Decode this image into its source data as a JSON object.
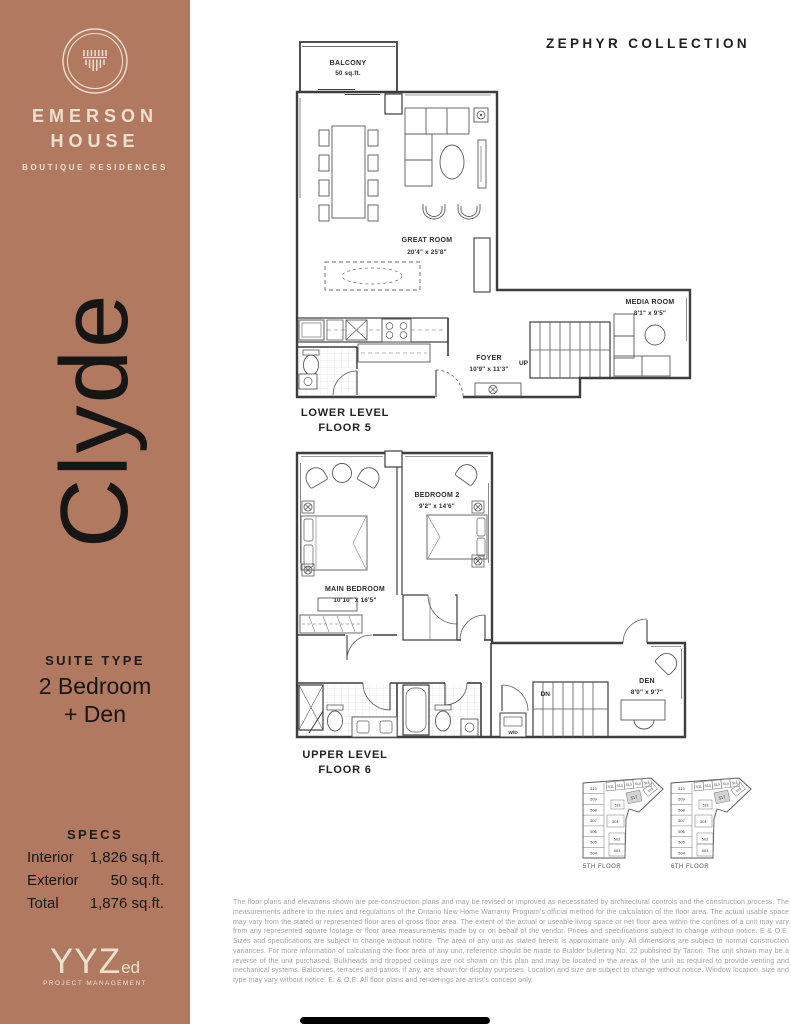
{
  "sidebar": {
    "brand_line1": "EMERSON",
    "brand_line2": "HOUSE",
    "brand_tagline": "BOUTIQUE RESIDENCES",
    "suite_name": "Clyde",
    "suite_type_heading": "SUITE TYPE",
    "suite_type_line1": "2 Bedroom",
    "suite_type_line2": "+ Den",
    "specs_heading": "SPECS",
    "specs": [
      {
        "label": "Interior",
        "value": "1,826 sq.ft."
      },
      {
        "label": "Exterior",
        "value": "50 sq.ft."
      },
      {
        "label": "Total",
        "value": "1,876 sq.ft."
      }
    ],
    "footer_brand": "YYZ",
    "footer_brand_suffix": "ed",
    "footer_brand_sub": "PROJECT MANAGEMENT",
    "accent_color": "#b1795f",
    "cream_color": "#ece0d1"
  },
  "header": {
    "collection_title": "ZEPHYR COLLECTION"
  },
  "plans": {
    "lower": {
      "caption_line1": "LOWER LEVEL",
      "caption_line2": "FLOOR 5",
      "balcony_name": "BALCONY",
      "balcony_size": "50 sq.ft.",
      "great_room_name": "GREAT ROOM",
      "great_room_size": "20'4\" x 25'8\"",
      "media_room_name": "MEDIA ROOM",
      "media_room_size": "8'1\" x 9'5\"",
      "foyer_name": "FOYER",
      "foyer_size": "10'9\" x 11'3\"",
      "stair_label": "UP"
    },
    "upper": {
      "caption_line1": "UPPER LEVEL",
      "caption_line2": "FLOOR 6",
      "bedroom2_name": "BEDROOM 2",
      "bedroom2_size": "9'2\" x 14'6\"",
      "main_bedroom_name": "MAIN BEDROOM",
      "main_bedroom_size": "10'10\" x 16'5\"",
      "den_name": "DEN",
      "den_size": "8'0\" x 9'7\"",
      "stair_label": "DN",
      "laundry_label": "W/D"
    }
  },
  "key_plans": [
    {
      "caption": "5TH FLOOR",
      "highlighted_unit": "517",
      "column_units": [
        "510",
        "509",
        "508",
        "507",
        "506",
        "505",
        "504"
      ],
      "top_units": [
        "511",
        "512",
        "513",
        "514",
        "515"
      ],
      "mid_units": [
        "518",
        "517",
        "516"
      ],
      "inner_units": [
        "501",
        "502",
        "503"
      ]
    },
    {
      "caption": "6TH FLOOR",
      "highlighted_unit": "517",
      "column_units": [
        "510",
        "509",
        "508",
        "507",
        "506",
        "505",
        "504"
      ],
      "top_units": [
        "511",
        "512",
        "513",
        "514",
        "515"
      ],
      "mid_units": [
        "518",
        "517",
        "516"
      ],
      "inner_units": [
        "501",
        "502",
        "503"
      ]
    }
  ],
  "disclaimer": "The floor plans and elevations shown are pre-construction plans and may be revised or improved as necessitated by architectural controls and the construction process. The measurements adhere to the rules and regulations of the Ontario New Home Warranty Program's official method for the calculation of the floor area. The actual usable space may vary from the stated or represented floor area of gross floor area. The extent of the actual or useable living space or net floor area within the confines of a unit may vary from any represented square footage or floor area measurements made by or on behalf of the vendor. Prices and specifications subject to change without notice. E & O.E. Sizes and specifications are subject to change without notice. The area of any unit as stated herein is approximate only. All dimensions are subject to normal construction variances. For more information of calculating the floor area of any unit, reference should be made to Builder bulleting No. 22 published by Tarion. The unit shown may be a reverse of the unit purchased. Bulkheads and dropped ceilings are not shown on this plan and may be located in the areas of the unit as required to provide venting and mechanical systems. Balconies, terraces and patios, if any, are shown for display purposes. Location and size are subject to change without notice. Window location, size and type may vary without notice. E. & O.E. All floor plans and renderings are artist's concept only."
}
